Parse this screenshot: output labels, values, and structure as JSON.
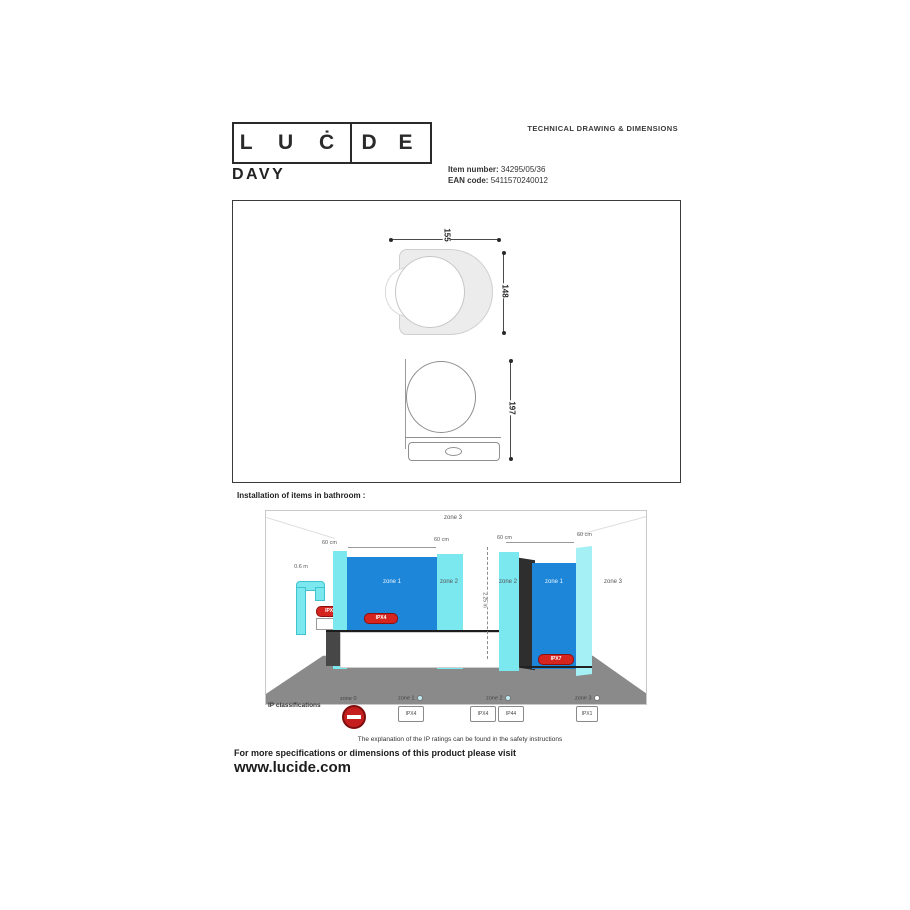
{
  "header": {
    "doc_title": "TECHNICAL DRAWING & DIMENSIONS",
    "logo": {
      "left": "L U Ċ",
      "right": "D E"
    },
    "product_name": "DAVY",
    "item_number_label": "Item number:",
    "item_number": "34295/05/36",
    "ean_label": "EAN code:",
    "ean_code": "5411570240012"
  },
  "drawing": {
    "top_view": {
      "width": "155",
      "depth": "148"
    },
    "front_view": {
      "height": "197"
    }
  },
  "bathroom": {
    "section_title": "Installation of items in bathroom :",
    "zone3_top": "zone 3",
    "dims": {
      "d60_1": "60 cm",
      "d60_2": "60 cm",
      "d60_3": "60 cm",
      "d60_4": "60 cm",
      "height": "2.25 m",
      "basin": "0.6 m"
    },
    "zones": {
      "bath_zone1": "zone 1",
      "bath_zone2": "zone 2",
      "shower_zone2": "zone 2",
      "shower_zone1": "zone 1",
      "zone3_right": "zone 3"
    },
    "badges": {
      "basin": "IPX4",
      "bath": "IPX4",
      "shower": "IPX7"
    },
    "legend": {
      "title": "IP classifications",
      "groups": [
        {
          "label": "zone 0"
        },
        {
          "label": "zone 1",
          "boxes": [
            "IPX4"
          ]
        },
        {
          "label": "zone 2",
          "boxes": [
            "IPX4",
            "IP44"
          ]
        },
        {
          "label": "zone 3",
          "boxes": [
            "IPX1"
          ]
        }
      ],
      "note": "The explanation of the IP ratings can be found in the safety instructions"
    }
  },
  "footer": {
    "line": "For more specifications or dimensions of this product please visit",
    "website": "www.lucide.com"
  },
  "colors": {
    "zone1_blue": "#1e86d8",
    "zone2_cyan": "#7be7ef",
    "badge_red": "#d6251f",
    "floor_gray": "#8a8a8a"
  }
}
